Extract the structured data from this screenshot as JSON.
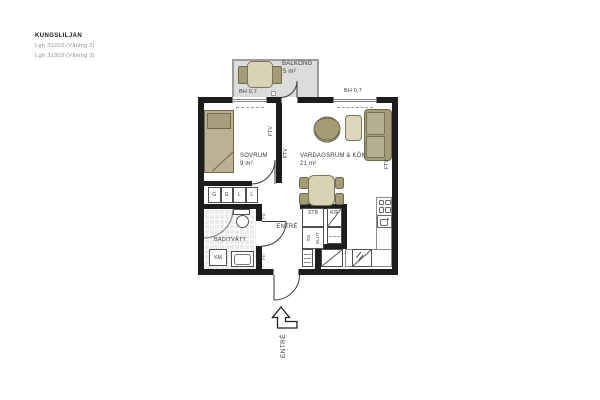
{
  "header": {
    "project": "KUNGSLILJAN",
    "apartments": [
      "Lgh 31203 (Våning 2)",
      "Lgh 31303 (Våning 3)"
    ]
  },
  "rooms": {
    "balcony_name": "BALKONG",
    "balcony_area": "5 m²",
    "bedroom_name": "SOVRUM",
    "bedroom_area": "9 m²",
    "living_name": "VARDAGSRUM & KÖK",
    "living_area": "21 m²",
    "bath_name": "BAD/TVÄTT",
    "hall_name": "ENTRÉ"
  },
  "marks": {
    "bh": [
      "BH 0,7",
      "BH 0,7"
    ],
    "closets": [
      "G",
      "G",
      "L",
      "L"
    ],
    "km": "KM",
    "stb": "STB",
    "kf": "K/F",
    "sg": "SG",
    "elit": "EL/IT",
    "ftv": [
      "FTV",
      "FTV",
      "FTV"
    ],
    "fd": [
      "FD",
      "FD"
    ],
    "entry_direction": "ENTRÉ"
  },
  "colors": {
    "wall": "#1d1d1b",
    "furniture_olive": "#a49c77",
    "furniture_beige": "#d9d1b6",
    "bed": "#bbb296",
    "balcony_floor": "#dcdcdc",
    "bath_tile": "#ebebeb",
    "label_text": "#3a3a3a",
    "muted_text": "#8f8f8f"
  }
}
